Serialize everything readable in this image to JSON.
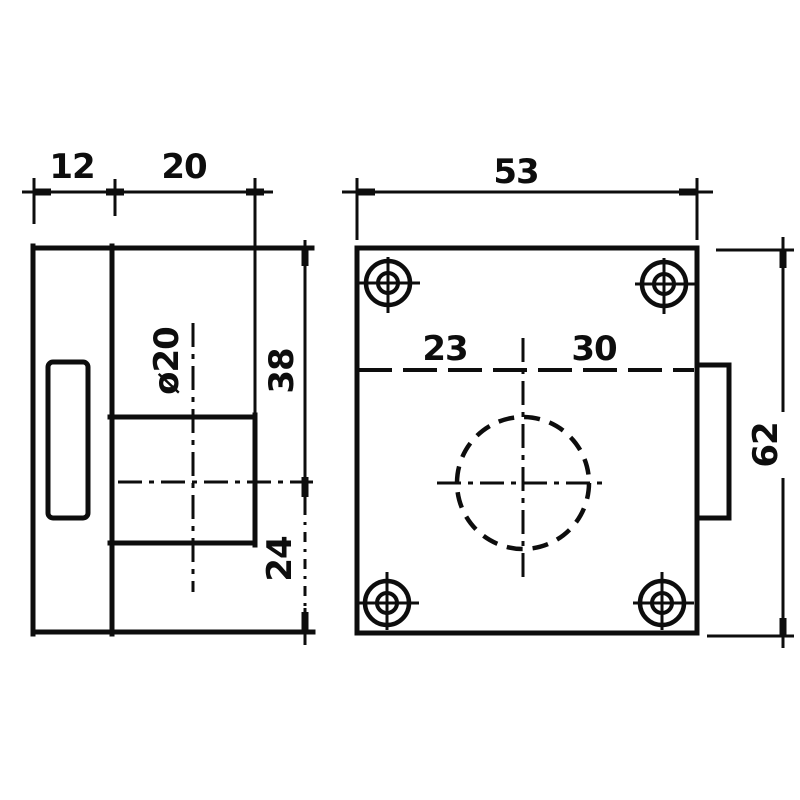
{
  "colors": {
    "background": "#ffffff",
    "ink": "#0d0d0d"
  },
  "side_view": {
    "dim_plate_thickness": "12",
    "dim_cylinder_length": "20",
    "dim_cylinder_diameter": "ø20",
    "dim_top_to_center": "38",
    "dim_center_to_bottom": "24"
  },
  "front_view": {
    "dim_overall_width": "53",
    "dim_center_offset_left": "23",
    "dim_center_offset_right": "30",
    "dim_overall_height": "62"
  }
}
